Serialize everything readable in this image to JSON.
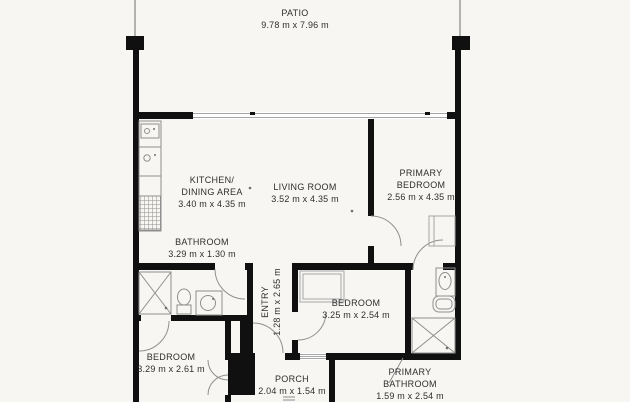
{
  "plan_title": "Apartment floor plan",
  "colors": {
    "wall": "#101010",
    "fixture_line": "#8f8f8f",
    "background": "#f7f6f3",
    "text": "#2e2e2e"
  },
  "rooms": {
    "patio": {
      "name": "PATIO",
      "dims": "9.78 m x 7.96 m"
    },
    "kitchen_dining": {
      "name1": "KITCHEN/",
      "name2": "DINING AREA",
      "dims": "3.40 m x 4.35 m"
    },
    "living_room": {
      "name": "LIVING ROOM",
      "dims": "3.52 m x 4.35 m"
    },
    "primary_bedroom": {
      "name1": "PRIMARY",
      "name2": "BEDROOM",
      "dims": "2.56 m x 4.35 m"
    },
    "bathroom": {
      "name": "BATHROOM",
      "dims": "3.29 m x 1.30 m"
    },
    "entry": {
      "name": "ENTRY",
      "dims": "1.28 m x 2.65 m"
    },
    "bedroom_middle": {
      "name": "BEDROOM",
      "dims": "3.25 m x 2.54 m"
    },
    "bedroom_lower": {
      "name": "BEDROOM",
      "dims": "3.29 m x 2.61 m"
    },
    "porch": {
      "name": "PORCH",
      "dims": "2.04 m x 1.54 m"
    },
    "primary_bathroom": {
      "name1": "PRIMARY",
      "name2": "BATHROOM",
      "dims": "1.59 m x 2.54 m"
    }
  }
}
